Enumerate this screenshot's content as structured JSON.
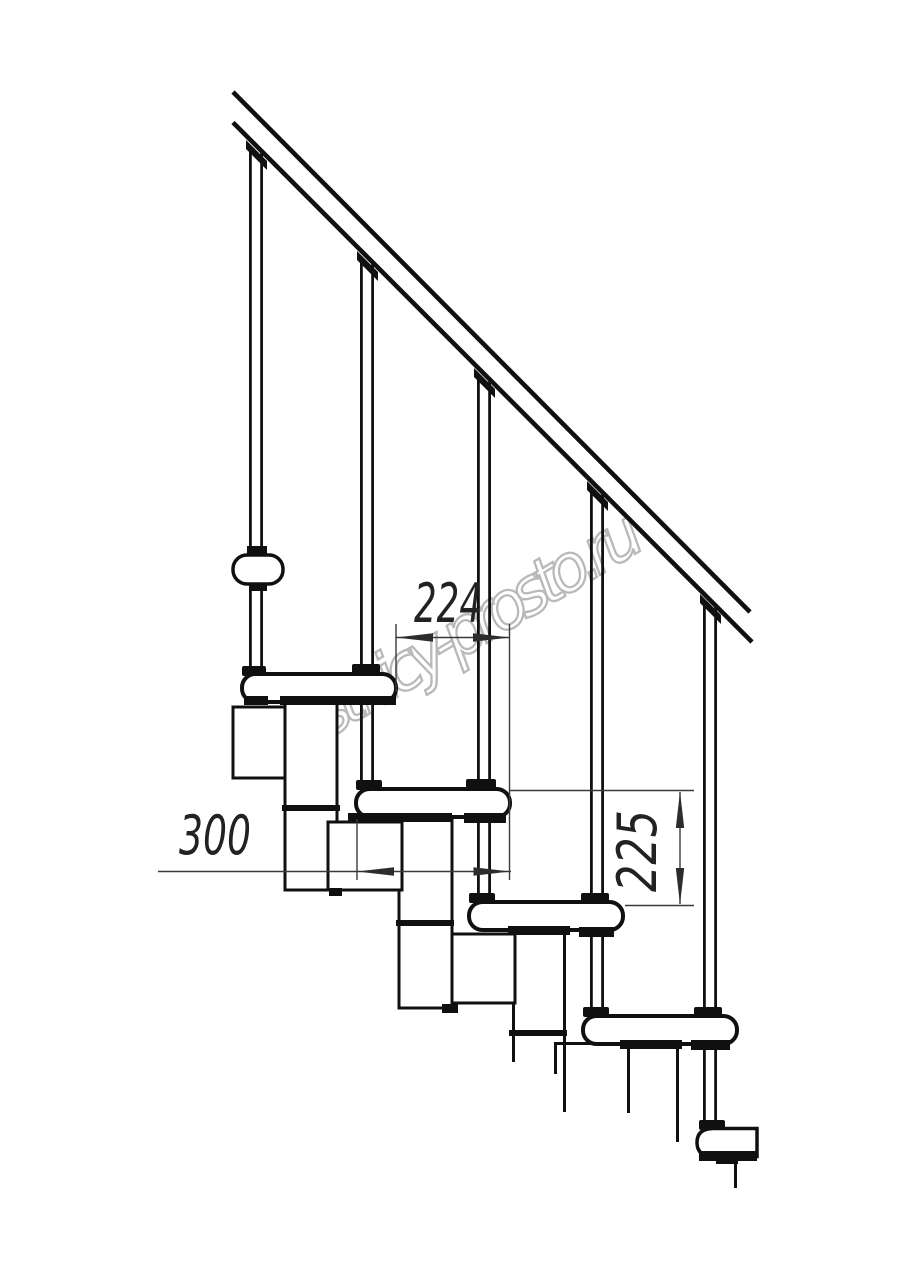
{
  "watermark": {
    "text": "lestnicy-prosto.ru",
    "color": "#a8a8a8"
  },
  "dimensions": {
    "step_run_mm": "224",
    "tread_depth_mm": "300",
    "step_rise_mm": "225"
  },
  "colors": {
    "line": "#101010",
    "dimension": "#333333",
    "background": "#ffffff"
  }
}
